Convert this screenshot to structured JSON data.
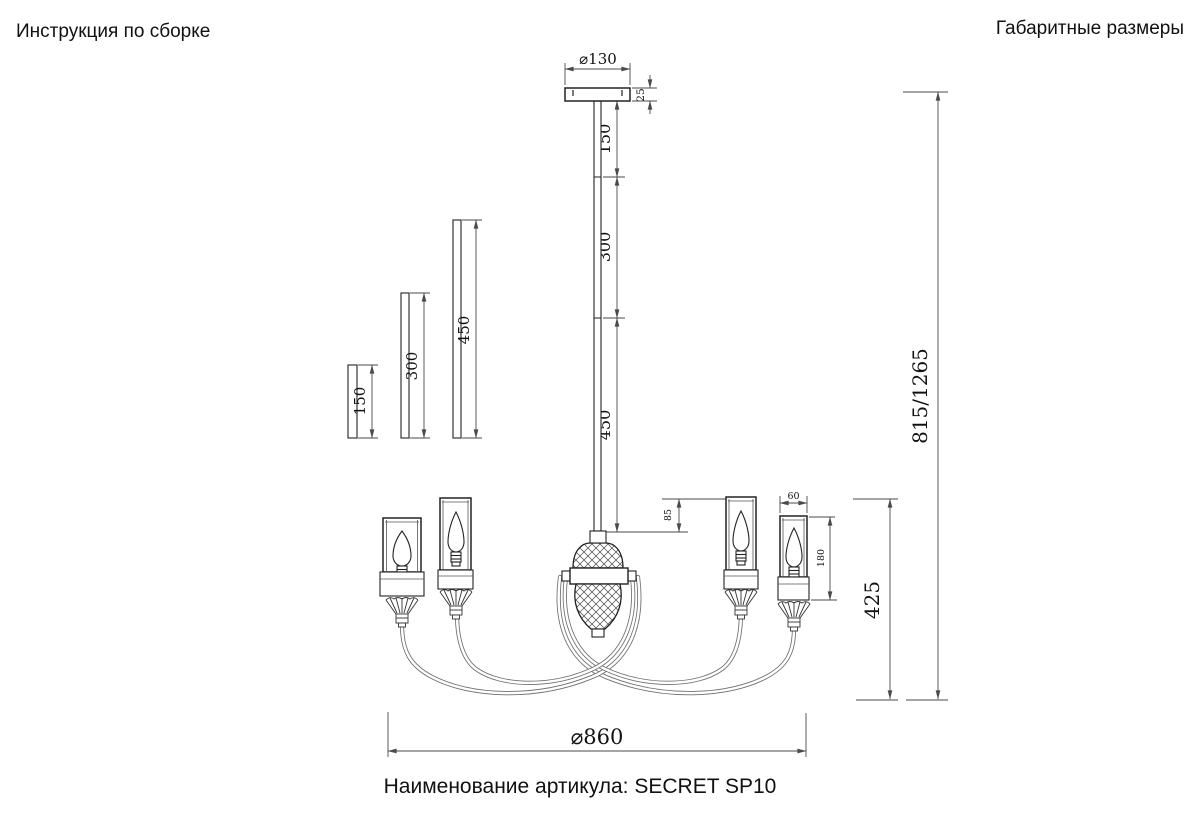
{
  "header": {
    "left_title": "Инструкция по сборке",
    "right_title": "Габаритные размеры"
  },
  "footer": {
    "article_label": "Наименование артикула: SECRET SP10"
  },
  "dims": {
    "canopy_diameter": "⌀130",
    "canopy_height": "25",
    "rod_segment_1": "150",
    "rod_segment_2": "300",
    "rod_segment_3": "450",
    "spare_rod_short": "150",
    "spare_rod_medium": "300",
    "spare_rod_long": "450",
    "shade_width": "60",
    "shade_height": "180",
    "hub_drop": "85",
    "body_height": "425",
    "overall_height": "815/1265",
    "overall_diameter": "⌀860"
  },
  "colors": {
    "background": "#ffffff",
    "outline": "#222222",
    "dimension_line": "#4a4a4a",
    "text": "#111111"
  }
}
